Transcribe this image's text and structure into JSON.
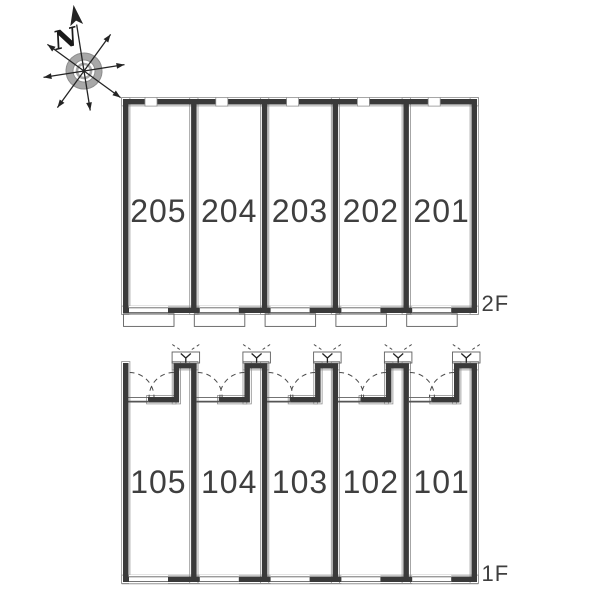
{
  "compass": {
    "north_label": "N"
  },
  "floors": [
    {
      "id": "2f",
      "label": "2F",
      "units": [
        {
          "number": "205"
        },
        {
          "number": "204"
        },
        {
          "number": "203"
        },
        {
          "number": "202"
        },
        {
          "number": "201"
        }
      ]
    },
    {
      "id": "1f",
      "label": "1F",
      "units": [
        {
          "number": "105"
        },
        {
          "number": "104"
        },
        {
          "number": "103"
        },
        {
          "number": "102"
        },
        {
          "number": "101"
        }
      ]
    }
  ],
  "colors": {
    "background": "#ffffff",
    "wall": "#3a3a3a",
    "wall_outline": "#8f8f8f",
    "thin_line": "#5f5f5f",
    "dashed_line": "#4a4a4a",
    "label_text": "#3f3f3f",
    "compass_ring": "#a8a8a8",
    "compass_ring_edge": "#8d8d8d",
    "compass_needle": "#242424"
  }
}
